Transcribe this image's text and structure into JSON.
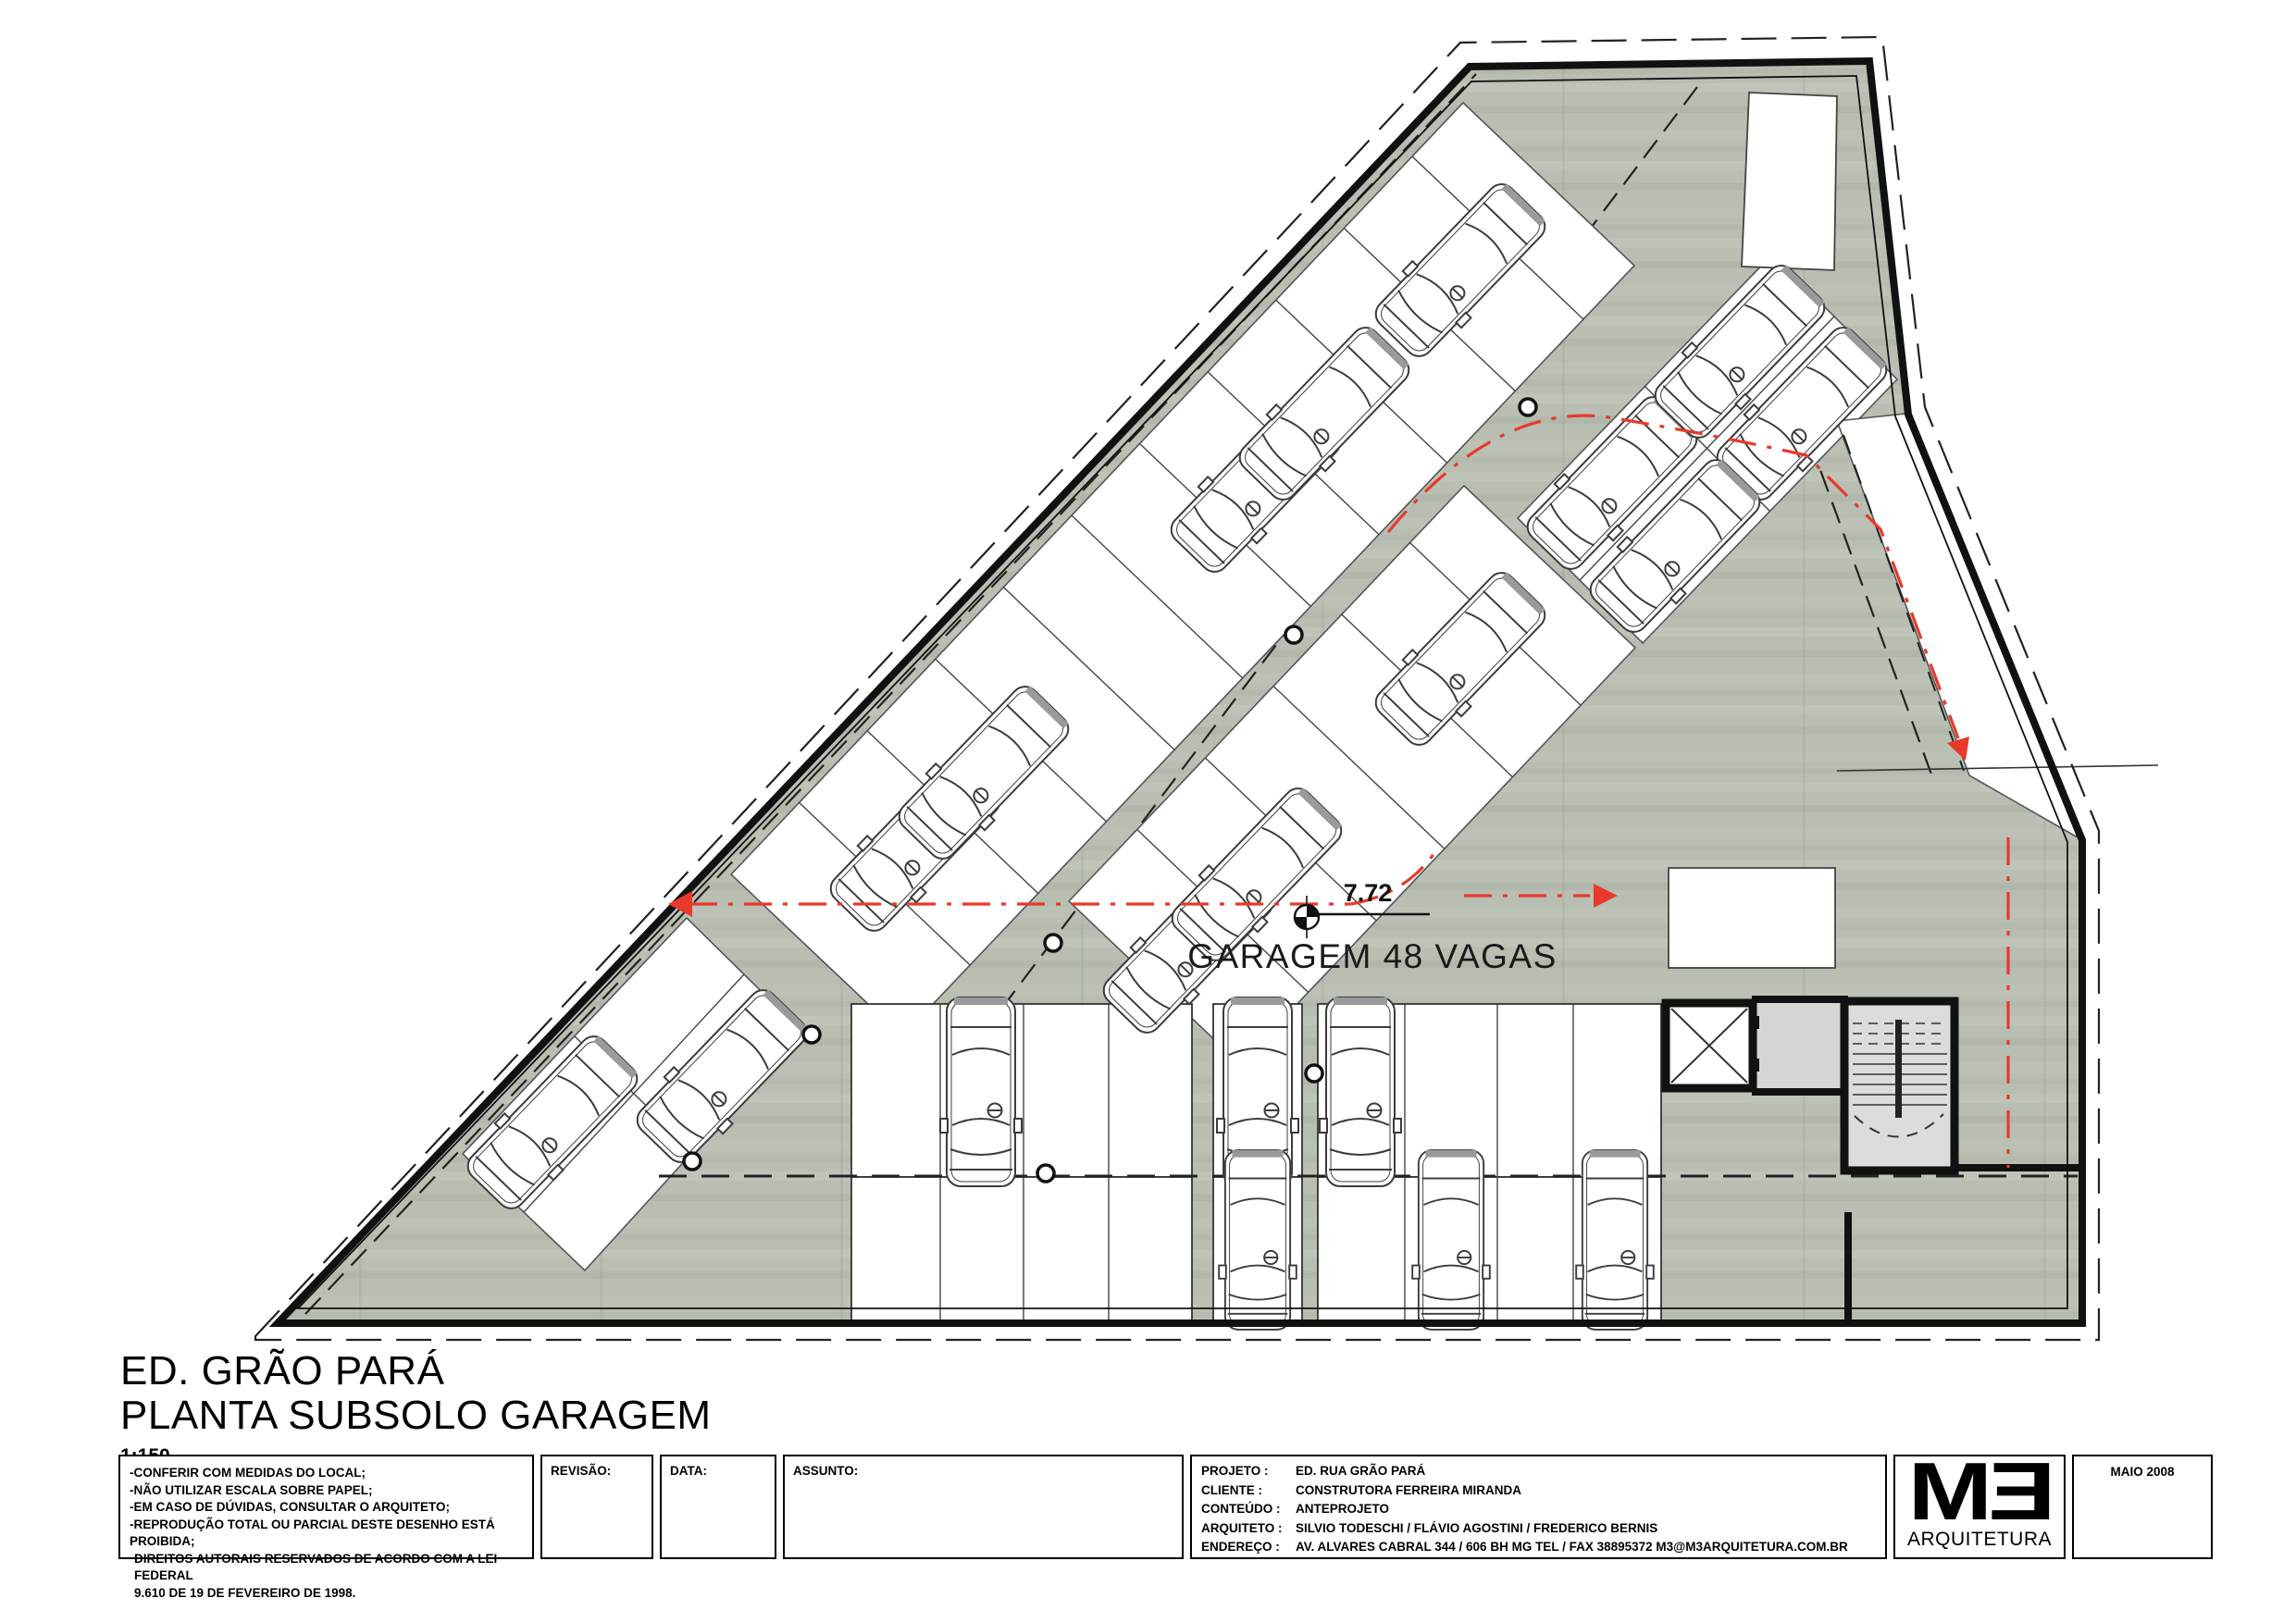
{
  "plan": {
    "garage_label": "GARAGEM 48 VAGAS",
    "level_value": "7.72"
  },
  "title": {
    "line1": "ED. GRÃO PARÁ",
    "line2": "PLANTA SUBSOLO GARAGEM",
    "scale": "1:150"
  },
  "titleblock": {
    "notes": [
      "-CONFERIR COM MEDIDAS DO LOCAL;",
      "-NÃO UTILIZAR ESCALA SOBRE PAPEL;",
      "-EM CASO DE DÚVIDAS, CONSULTAR O ARQUITETO;",
      "-REPRODUÇÃO TOTAL OU PARCIAL DESTE DESENHO ESTÁ PROIBIDA;",
      "DIREITOS AUTORAIS RESERVADOS DE ACORDO COM A LEI FEDERAL",
      "9.610 DE 19 DE FEVEREIRO DE 1998."
    ],
    "revisao_label": "REVISÃO:",
    "data_label": "DATA:",
    "assunto_label": "ASSUNTO:",
    "projeto_label": "PROJETO :",
    "projeto": "ED. RUA GRÃO PARÁ",
    "cliente_label": "CLIENTE :",
    "cliente": "CONSTRUTORA FERREIRA MIRANDA",
    "conteudo_label": "CONTEÚDO :",
    "conteudo": "ANTEPROJETO",
    "arquiteto_label": "ARQUITETO :",
    "arquiteto": "SILVIO TODESCHI / FLÁVIO AGOSTINI / FREDERICO BERNIS",
    "endereco_label": "ENDEREÇO :",
    "endereco": "AV. ALVARES CABRAL 344 / 606 BH MG TEL / FAX 38895372   M3@M3ARQUITETURA.COM.BR",
    "logo_text": "MƎ",
    "logo_sub": "ARQUITETURA",
    "date": "MAIO 2008"
  },
  "colors": {
    "floor": "#b8beb2",
    "circulation_red": "#e8392b",
    "wall_black": "#111111"
  }
}
